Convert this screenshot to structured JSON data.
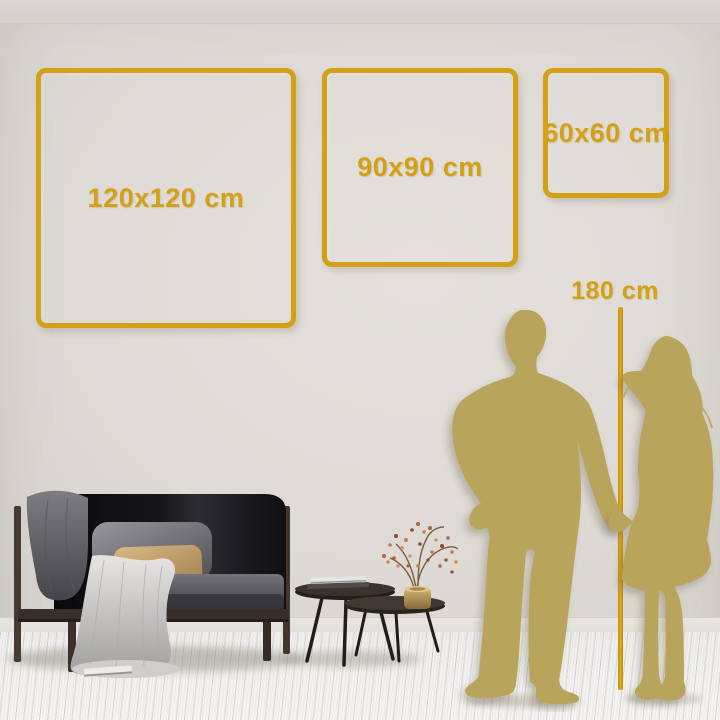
{
  "frames": [
    {
      "label": "120x120 cm"
    },
    {
      "label": "90x90 cm"
    },
    {
      "label": "60x60 cm"
    }
  ],
  "height_marker": {
    "label": "180 cm"
  },
  "colors": {
    "accent_gold": "#d4a017",
    "silhouette_gold": "#b9a45c",
    "wall": "#dcd8d3",
    "floor": "#f3f2f0"
  }
}
